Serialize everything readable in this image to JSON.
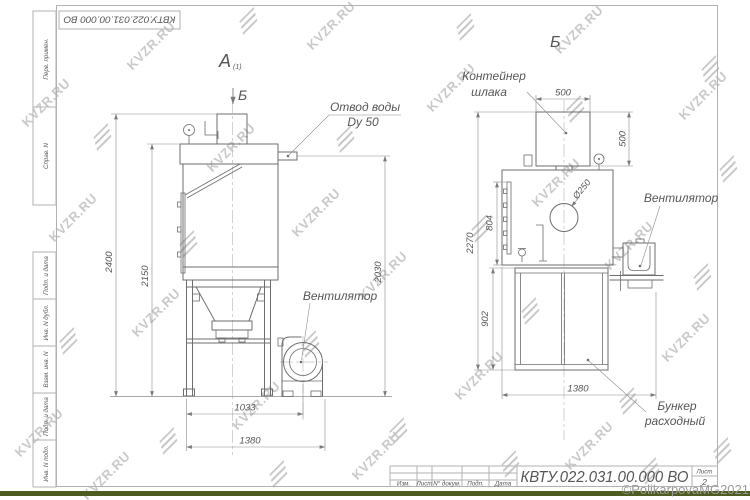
{
  "watermark": {
    "text": "KVZR.RU",
    "copyright": "©PolikarpovaMG2021"
  },
  "frame": {
    "corner_stamp": "КВТУ.022.031.00.000  ВО",
    "side_labels": {
      "perv": "Перв. примен.",
      "sprav": "Справ. N",
      "podp_data": "Подп. и дата",
      "inv_dubl": "Инв. N дубл.",
      "vzam": "Взам. инв. N",
      "inv_podl": "Инв. N подл."
    }
  },
  "title_block": {
    "designation": "КВТУ.022.031.00.000  ВО",
    "columns": {
      "izm": "Изм.",
      "list": "Лист",
      "n_dokum": "N° докум.",
      "podp": "Подп.",
      "data": "Дата"
    },
    "sheet_label": "Лист",
    "sheet_number": "2"
  },
  "views": {
    "a": {
      "label": "А",
      "sub": "(1)",
      "section_arrow": "Б",
      "callouts": {
        "otvod_1": "Отвод воды",
        "otvod_2": "Dy 50",
        "fan": "Вентилятор"
      },
      "dims": {
        "h2400": "2400",
        "h2150": "2150",
        "h2030": "2030",
        "w1033": "1033",
        "w1380": "1380"
      }
    },
    "b": {
      "label": "Б",
      "callouts": {
        "container_1": "Контейнер",
        "container_2": "шлака",
        "fan": "Вентилятор",
        "bunker_1": "Бункер",
        "bunker_2": "расходный",
        "d250": "Ø250"
      },
      "dims": {
        "w500": "500",
        "h500": "500",
        "h804": "804",
        "h902": "902",
        "h2270": "2270",
        "w1380": "1380"
      }
    }
  }
}
